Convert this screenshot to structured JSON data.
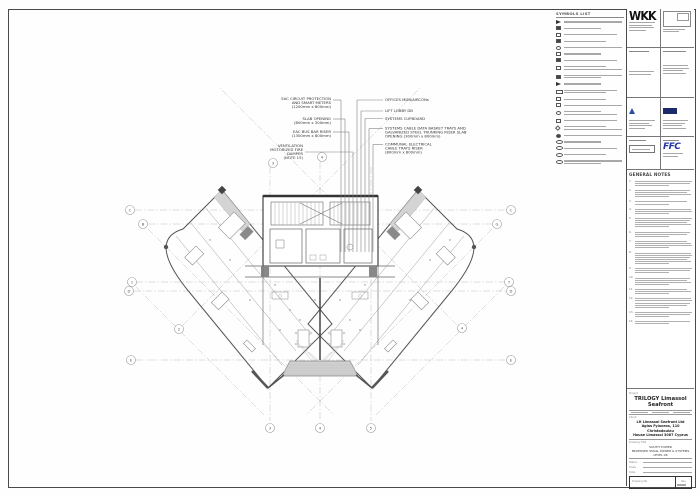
{
  "callouts": {
    "left": [
      {
        "lines": [
          "EAC CIRCUIT PROTECTION",
          "AND SMART METERS",
          "(1200mm x 800mm)"
        ]
      },
      {
        "lines": [
          "SLAB OPENING",
          "(800mm x 300mm)"
        ]
      },
      {
        "lines": [
          "EAC BUS BAR RISER",
          "(1300mm x 800mm)"
        ]
      },
      {
        "lines": [
          "VENTILATION",
          "MOTORIZED FIRE",
          "DAMPER",
          "(NOTE 15)"
        ]
      }
    ],
    "right": [
      {
        "lines": [
          "OFFICES MDB/AIRCONs"
        ]
      },
      {
        "lines": [
          "LIFT LOBBY DB"
        ]
      },
      {
        "lines": [
          "SYSTEMS CUPBOARD"
        ]
      },
      {
        "lines": [
          "SYSTEMS CABLE DATA BASKET TRAYS AND",
          "GALVANIZED STEEL TRUNKING RISER SLAB",
          "OPENING (300mm x 800mm)"
        ]
      },
      {
        "lines": [
          "COMMUNAL ELECTRICAL",
          "CABLE TRAYS RISER",
          "(800mm x 800mm)"
        ]
      }
    ]
  },
  "legend": {
    "title": "SYMBOLS LIST",
    "items": [
      {
        "symbol": "tri",
        "lines": 1
      },
      {
        "symbol": "boxf",
        "lines": 1
      },
      {
        "symbol": "box",
        "lines": 1
      },
      {
        "symbol": "boxf",
        "lines": 1
      },
      {
        "symbol": "circ",
        "lines": 1
      },
      {
        "symbol": "box",
        "lines": 1
      },
      {
        "symbol": "boxf",
        "lines": 1
      },
      {
        "symbol": "box",
        "lines": 2
      },
      {
        "symbol": "boxf",
        "lines": 2
      },
      {
        "symbol": "tri",
        "lines": 1
      },
      {
        "symbol": "wide",
        "lines": 2
      },
      {
        "symbol": "box",
        "lines": 1
      },
      {
        "symbol": "box",
        "lines": 1
      },
      {
        "symbol": "circ",
        "lines": 2
      },
      {
        "symbol": "box",
        "lines": 1
      },
      {
        "symbol": "dia",
        "lines": 2
      },
      {
        "symbol": "circf",
        "lines": 1
      },
      {
        "symbol": "oval",
        "lines": 1
      },
      {
        "symbol": "oval",
        "lines": 1
      },
      {
        "symbol": "oval",
        "lines": 1
      },
      {
        "symbol": "oval",
        "lines": 2
      }
    ]
  },
  "plan": {
    "grid_bubbles": [
      {
        "label": "C",
        "x": 130,
        "y": 210
      },
      {
        "label": "B",
        "x": 143,
        "y": 224
      },
      {
        "label": "1",
        "x": 132,
        "y": 282
      },
      {
        "label": "D",
        "x": 129,
        "y": 291
      },
      {
        "label": "E",
        "x": 131,
        "y": 360
      },
      {
        "label": "2",
        "x": 179,
        "y": 329
      },
      {
        "label": "C",
        "x": 511,
        "y": 210
      },
      {
        "label": "G",
        "x": 497,
        "y": 224
      },
      {
        "label": "7",
        "x": 509,
        "y": 282
      },
      {
        "label": "D",
        "x": 511,
        "y": 291
      },
      {
        "label": "E",
        "x": 511,
        "y": 360
      },
      {
        "label": "4",
        "x": 462,
        "y": 328
      },
      {
        "label": "3",
        "x": 270,
        "y": 428
      },
      {
        "label": "4",
        "x": 320,
        "y": 428
      },
      {
        "label": "5",
        "x": 371,
        "y": 428
      },
      {
        "label": "3",
        "x": 273,
        "y": 163
      },
      {
        "label": "4",
        "x": 322,
        "y": 157
      }
    ]
  },
  "titleblock": {
    "firm_logo": "WKK",
    "ffc_logo": "FFC",
    "general_notes_title": "GENERAL NOTES",
    "project_name": "TRILOGY Limassol Seafront",
    "client_lines": [
      "LH Limassol Seafront Ltd",
      "Agias Fylaxeos, 110 Christodoulou",
      "House Limassol 3087 Cyprus"
    ],
    "drawing_title_lines": [
      "SOUTH TOWER",
      "PROPOSED SMALL POWER & SYSTEMS",
      "LEVEL 06"
    ],
    "labels": {
      "project": "Project",
      "client": "Client",
      "drawing_title": "Drawing Title",
      "status": "Status",
      "scale": "Scale",
      "date": "Date",
      "drawing_no": "Drawing No.",
      "rev": "Rev"
    },
    "notes": [
      {
        "num": "1.",
        "lines": 3
      },
      {
        "num": "2.",
        "lines": 4
      },
      {
        "num": "3.",
        "lines": 2
      },
      {
        "num": "4.",
        "lines": 3
      },
      {
        "num": "5.",
        "lines": 5
      },
      {
        "num": "6.",
        "lines": 3
      },
      {
        "num": "7.",
        "lines": 4
      },
      {
        "num": "8.",
        "lines": 6
      },
      {
        "num": "9.",
        "lines": 3
      },
      {
        "num": "10.",
        "lines": 4
      },
      {
        "num": "11.",
        "lines": 3
      },
      {
        "num": "12.",
        "lines": 5
      },
      {
        "num": "13.",
        "lines": 3
      },
      {
        "num": "14.",
        "lines": 2
      }
    ]
  },
  "colors": {
    "wall": "#4a4a4a",
    "thin_line": "#9a9a9a",
    "grid_line": "#bcbcbc",
    "shade": "#cfcfcf",
    "architect_logo_blue": "#2b4ea0",
    "engineer_logo_navy": "#1b2a6b",
    "ffc_blue": "#2637a8"
  }
}
